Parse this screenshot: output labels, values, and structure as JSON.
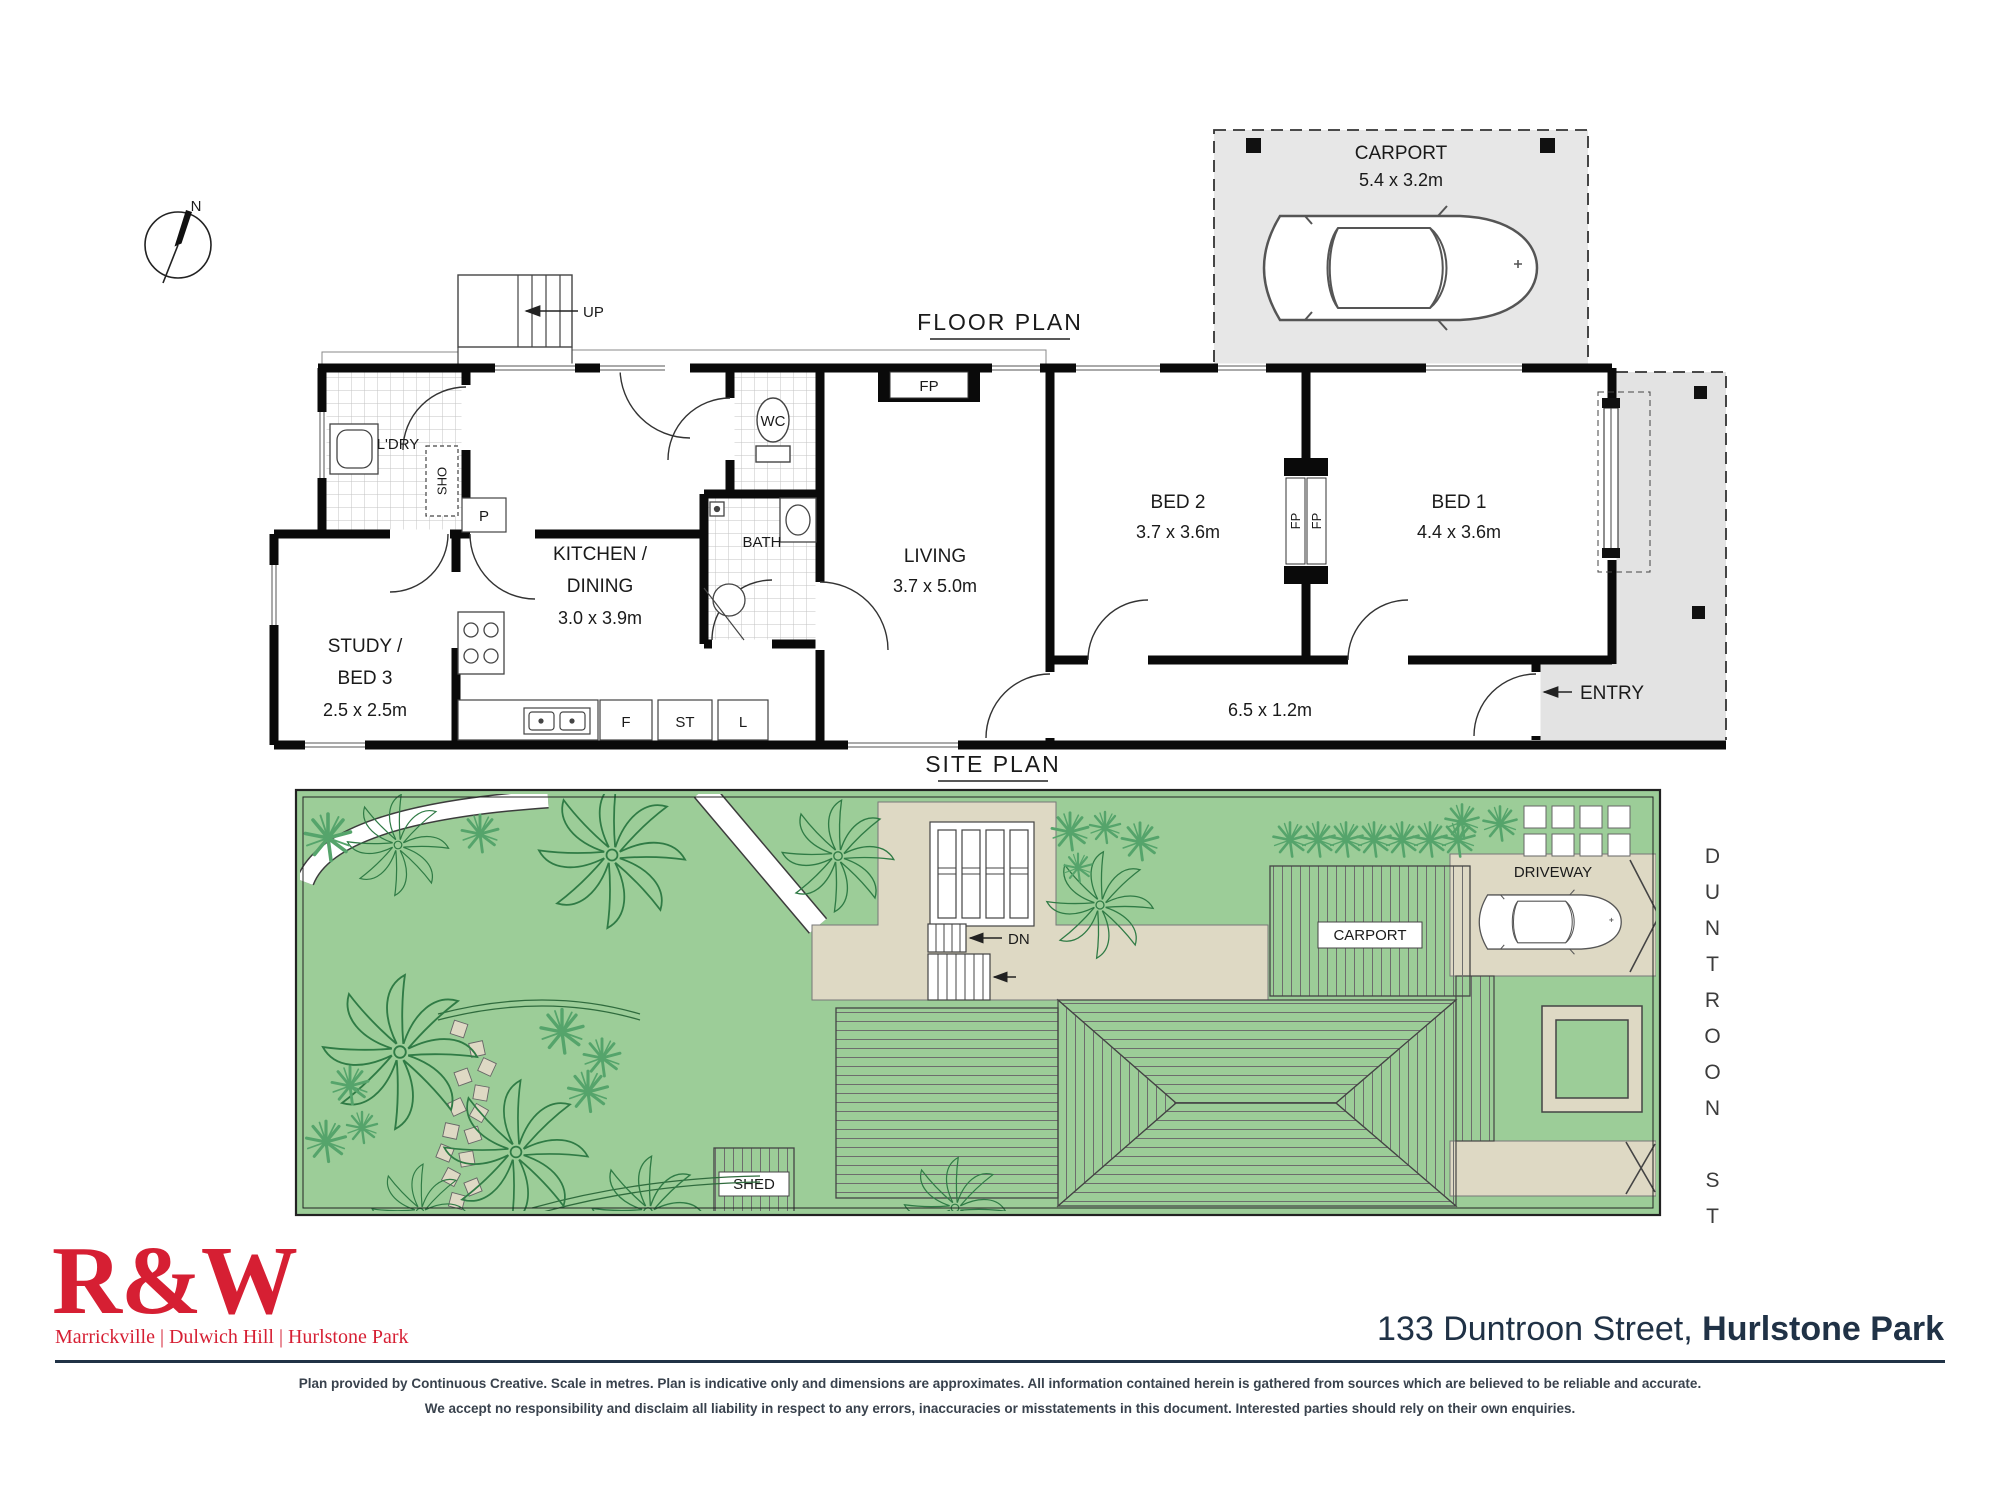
{
  "compass": {
    "north_label": "N"
  },
  "floor_plan": {
    "title": "FLOOR PLAN",
    "carport_label": "CARPORT",
    "carport_dims": "5.4 x 3.2m",
    "stairs_up_label": "UP",
    "laundry_label": "L'DRY",
    "shower_label": "SHO",
    "pantry_label": "P",
    "wc_label": "WC",
    "bath_label": "BATH",
    "kitchen_label_line1": "KITCHEN /",
    "kitchen_label_line2": "DINING",
    "kitchen_dims": "3.0 x 3.9m",
    "study_label_line1": "STUDY /",
    "study_label_line2": "BED 3",
    "study_dims": "2.5 x 2.5m",
    "fridge_label": "F",
    "store_label": "ST",
    "linen_label": "L",
    "living_label": "LIVING",
    "living_dims": "3.7 x 5.0m",
    "fireplace_label": "FP",
    "bed2_label": "BED 2",
    "bed2_dims": "3.7 x 3.6m",
    "bed1_label": "BED 1",
    "bed1_dims": "4.4 x 3.6m",
    "hall_dims": "6.5 x 1.2m",
    "entry_label": "ENTRY"
  },
  "site_plan": {
    "title": "SITE PLAN",
    "down_label": "DN",
    "shed_label": "SHED",
    "carport_label": "CARPORT",
    "driveway_label": "DRIVEWAY",
    "street_label": "DUNTROON ST"
  },
  "branding": {
    "logo_text": "R&W",
    "offices": "Marrickville | Dulwich Hill | Hurlstone Park",
    "address_street": "133 Duntroon Street, ",
    "address_suburb": "Hurlstone Park"
  },
  "disclaimer": {
    "line1": "Plan provided by Continuous Creative. Scale in metres. Plan is indicative only and dimensions are approximates. All information contained herein is gathered from sources which are believed to be reliable and accurate.",
    "line2": "We accept no responsibility and disclaim all liability in respect to any errors, inaccuracies or misstatements in this document. Interested parties should rely on their own enquiries."
  },
  "colors": {
    "brand_red": "#d61f33",
    "navy": "#203246",
    "lawn_green": "#9ccd98",
    "tree_green": "#2f7b45",
    "fern_green": "#55a46b",
    "paving_beige": "#ded9c4",
    "concrete_gray": "#e7e7e7"
  }
}
